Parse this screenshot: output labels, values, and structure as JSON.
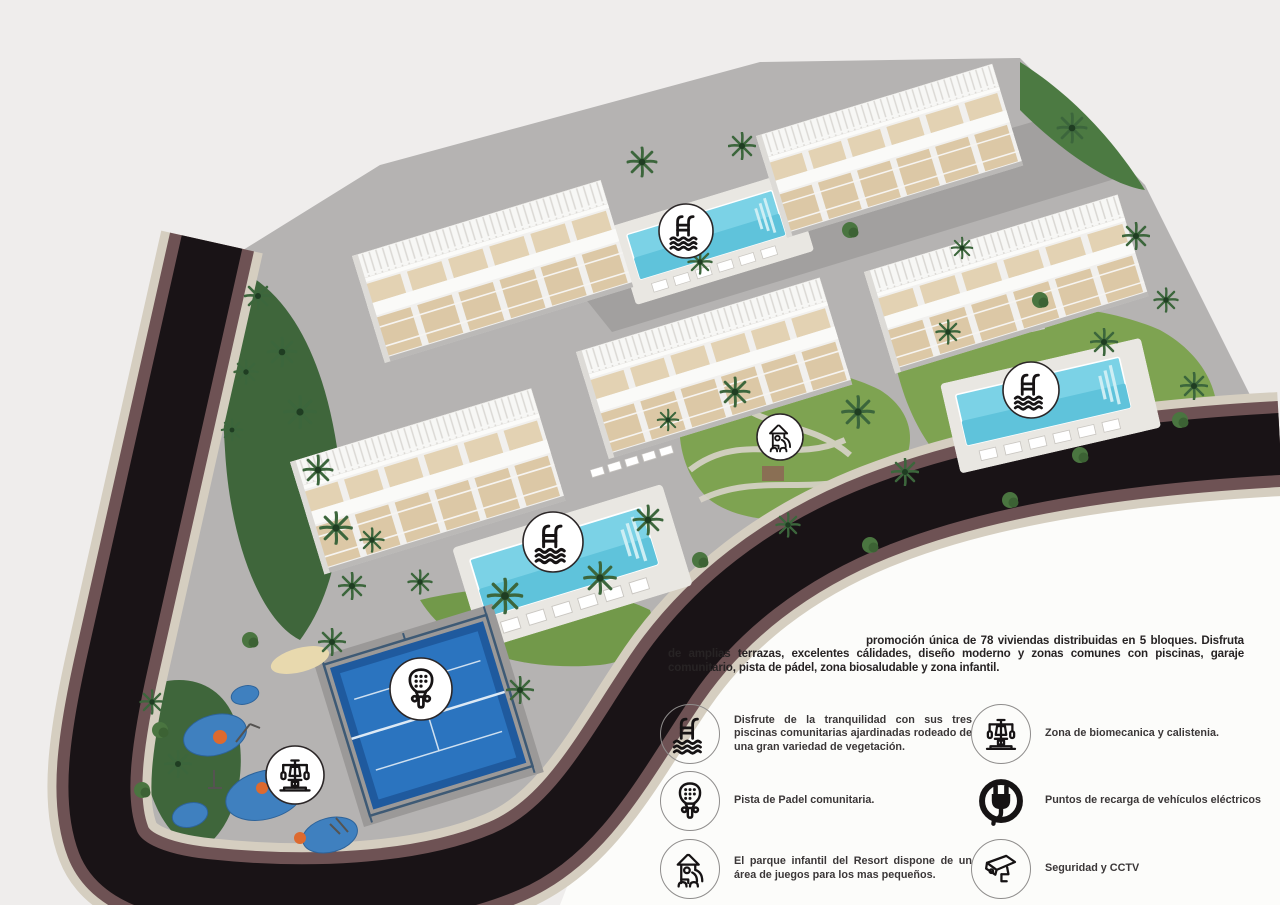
{
  "intro": {
    "text": "promoción única de 78 viviendas distribuidas en 5 bloques. Disfruta de amplias terrazas, excelentes cálidades, diseño moderno y zonas comunes con piscinas, garaje comunitario, pista de pádel, zona biosaludable y zona infantil."
  },
  "legend": {
    "columns": [
      {
        "items": [
          {
            "icon": "pool-icon",
            "text": "Disfrute de la tranquilidad con sus tres piscinas comunitarias ajardinadas rodeado de una gran variedad de vegetación."
          },
          {
            "icon": "padel-racket-icon",
            "text": "Pista de Padel comunitaria."
          },
          {
            "icon": "playground-icon",
            "text": "El parque infantil del Resort dispone de un área de juegos para los mas pequeños."
          }
        ]
      },
      {
        "items": [
          {
            "icon": "biomechanics-icon",
            "text": "Zona de biomecanica y calistenia."
          },
          {
            "icon": "ev-charger-icon",
            "text": "Puntos de recarga de vehículos eléctricos"
          },
          {
            "icon": "cctv-icon",
            "text": "Seguridad y CCTV"
          }
        ]
      }
    ]
  },
  "site": {
    "badges": [
      {
        "name": "pool-badge-top",
        "icon": "pool-icon",
        "x": 686,
        "y": 231,
        "r": 27
      },
      {
        "name": "pool-badge-right",
        "icon": "pool-icon",
        "x": 1031,
        "y": 390,
        "r": 28
      },
      {
        "name": "pool-badge-center",
        "icon": "pool-icon",
        "x": 553,
        "y": 542,
        "r": 30
      },
      {
        "name": "playground-badge",
        "icon": "playground-icon",
        "x": 780,
        "y": 437,
        "r": 23
      },
      {
        "name": "padel-badge",
        "icon": "padel-racket-icon",
        "x": 421,
        "y": 689,
        "r": 31
      },
      {
        "name": "biomech-badge",
        "icon": "biomechanics-icon",
        "x": 295,
        "y": 775,
        "r": 29
      }
    ],
    "colors": {
      "background": "#efedec",
      "paper_white": "#fcfcfa",
      "road_asphalt": "#191316",
      "road_embankment": "#6e5254",
      "stone_wall": "#d5cec0",
      "paving": "#b5b3b2",
      "grass": "#7ea351",
      "dense_vegetation": "#3f663b",
      "pool_water": "#7bd2e6",
      "padel_court": "#1f5a9e",
      "play_surface": "#3f80bf",
      "terrace_wood": "#dcc8a6"
    }
  }
}
